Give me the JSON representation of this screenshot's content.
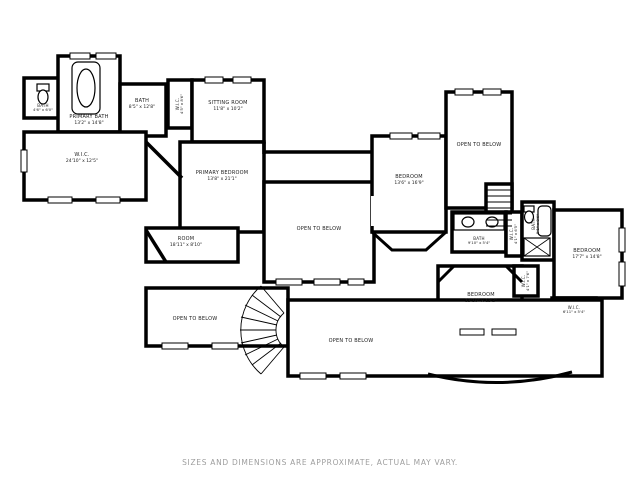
{
  "disclaimer": "SIZES AND DIMENSIONS ARE APPROXIMATE, ACTUAL MAY VARY.",
  "colors": {
    "wall": "#000000",
    "background": "#ffffff",
    "disclaimer_text": "#9e9e9e"
  },
  "rooms": {
    "bath_small_tl": {
      "name": "BATH",
      "dims": "4'6\" x 6'0\""
    },
    "primary_bath": {
      "name": "PRIMARY BATH",
      "dims": "13'2\" x 14'8\""
    },
    "bath_upper": {
      "name": "BATH",
      "dims": "8'5\" x 12'8\""
    },
    "wic_primary": {
      "name": "W.I.C.",
      "dims": "24'10\" x 12'5\""
    },
    "wic_hall": {
      "name": "W.I.C.",
      "dims": "4'5\" x 8'6\""
    },
    "sitting_room": {
      "name": "SITTING ROOM",
      "dims": "11'8\" x 10'2\""
    },
    "primary_bedroom": {
      "name": "PRIMARY BEDROOM",
      "dims": "13'8\" x 21'1\""
    },
    "room": {
      "name": "ROOM",
      "dims": "18'11\" x 8'10\""
    },
    "open_center": {
      "name": "OPEN TO BELOW"
    },
    "open_top_right": {
      "name": "OPEN TO BELOW"
    },
    "bedroom_top": {
      "name": "BEDROOM",
      "dims": "13'6\" x 16'9\""
    },
    "bath_hall": {
      "name": "BATH",
      "dims": "9'10\" x 5'4\""
    },
    "wic_small": {
      "name": "W.I.C.",
      "dims": "4'1\" x 6'5\""
    },
    "bath_right": {
      "name": "BATH",
      "dims": "5'1\" x 8'6\""
    },
    "closet_bottom": {
      "name": "W.I.C.",
      "dims": "4'1\" x 7'6\""
    },
    "bedroom_right": {
      "name": "BEDROOM",
      "dims": "17'7\" x 14'8\""
    },
    "bedroom_bottom": {
      "name": "BEDROOM",
      "dims": "13'10\" x 13'2\""
    },
    "wic_right": {
      "name": "W.I.C.",
      "dims": "6'11\" x 5'4\""
    },
    "open_left": {
      "name": "OPEN TO BELOW"
    },
    "open_bottom": {
      "name": "OPEN TO BELOW"
    }
  }
}
